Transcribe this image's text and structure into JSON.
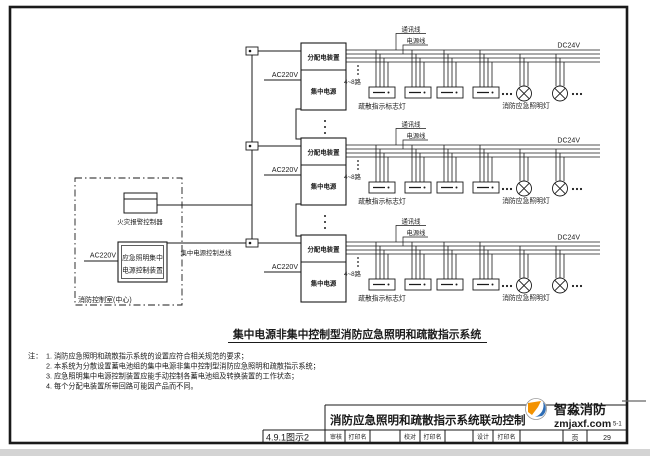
{
  "colors": {
    "ink": "#1a1a1a",
    "paper": "#ffffff",
    "watermark_orange": "#f39200",
    "watermark_blue": "#2e6db5",
    "watermark_text": "#3d3d3d",
    "bottom_strip": "#d4d4d4"
  },
  "diagram": {
    "row": {
      "distribution_box": "分配电装置",
      "central_power": "集中电源",
      "ac_input": "AC220V",
      "comm_line": "通讯线",
      "power_line": "电源线",
      "dc_output": "DC24V",
      "circuits": "4~8路",
      "sign_lamp_label": "疏散指示标志灯",
      "emergency_lamp_label": "消防应急照明灯"
    },
    "control_room": {
      "fire_alarm_controller": "火灾报警控制器",
      "device_name_line1": "应急照明集中",
      "device_name_line2": "电源控制装置",
      "ac_input": "AC220V",
      "control_bus_label": "集中电源控制总线",
      "room_label": "消防控制室(中心)"
    },
    "caption": "集中电源非集中控制型消防应急照明和疏散指示系统"
  },
  "notes": {
    "prefix": "注：",
    "lines": [
      "1. 消防应急照明和疏散指示系统的设置应符合相关规范的要求；",
      "2. 本系统为分散设置蓄电池组的集中电源非集中控制型消防应急照明和疏散指示系统；",
      "3. 应急照明集中电源控制装置应能手动控制各蓄电池组及转换装置的工作状态；",
      "4. 每个分配电装置所带回路可能因产品而不同。"
    ]
  },
  "titleblock": {
    "figure_no": "4.9.1图示2",
    "drawing_title": "消防应急照明和疏散指示系统联动控制",
    "review_label": "审核",
    "review_value": "打印名",
    "proof_label": "校对",
    "proof_value": "打印名",
    "design_label": "设计",
    "design_value": "打印名",
    "page_label": "页",
    "page_no": "29",
    "doc_no_fragment": "5-1"
  },
  "watermark": {
    "brand": "智淼消防",
    "site": "zmjaxf.com"
  }
}
